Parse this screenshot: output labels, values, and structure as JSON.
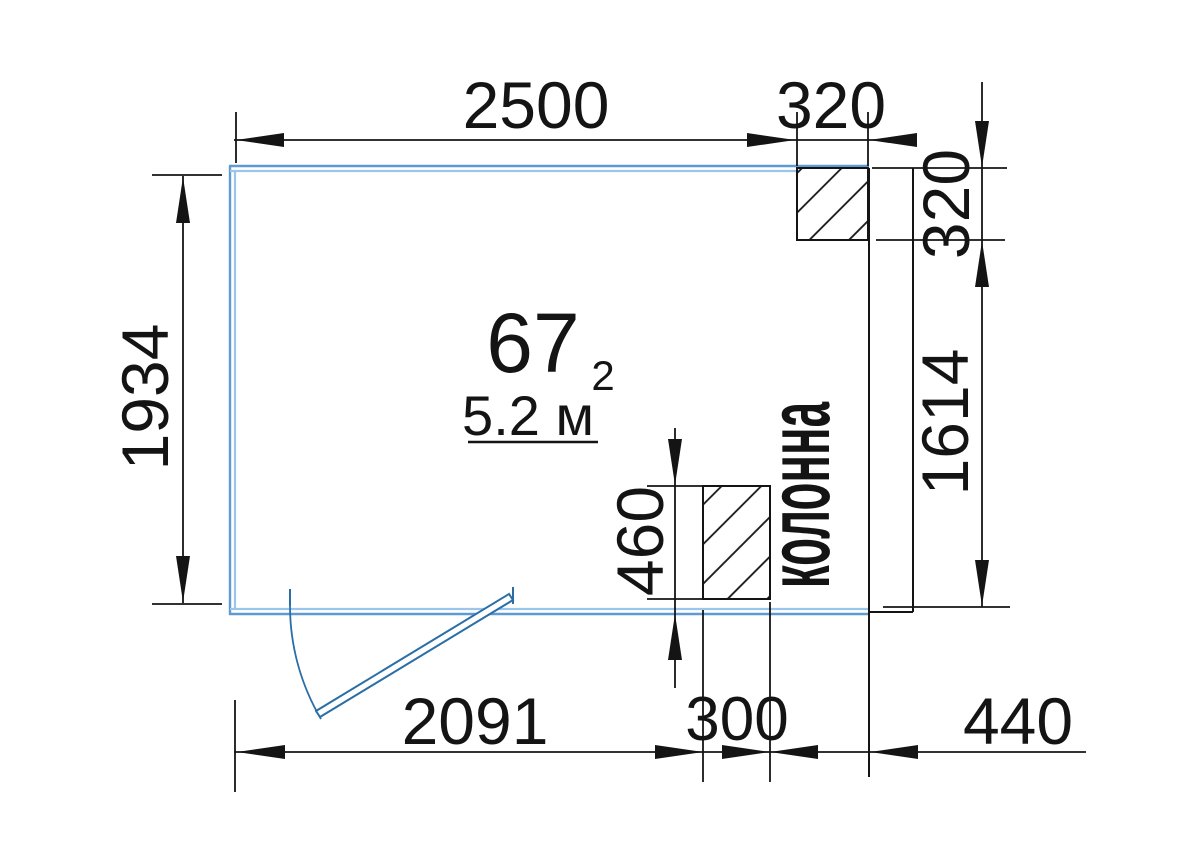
{
  "room": {
    "number": "67",
    "area": "5.2 м",
    "area_exponent": "2"
  },
  "column_label": "колонна",
  "dims": {
    "top_width": "2500",
    "top_column": "320",
    "right_column_height": "320",
    "right_wall": "1614",
    "left_height": "1934",
    "bottom_door": "2091",
    "bottom_column": "300",
    "bottom_right": "440",
    "column_depth": "460"
  },
  "colors": {
    "wall_outer": "#5f9ad2",
    "wall_inner": "#9cc5ec",
    "door": "#2a6ea6",
    "line": "#141414"
  }
}
